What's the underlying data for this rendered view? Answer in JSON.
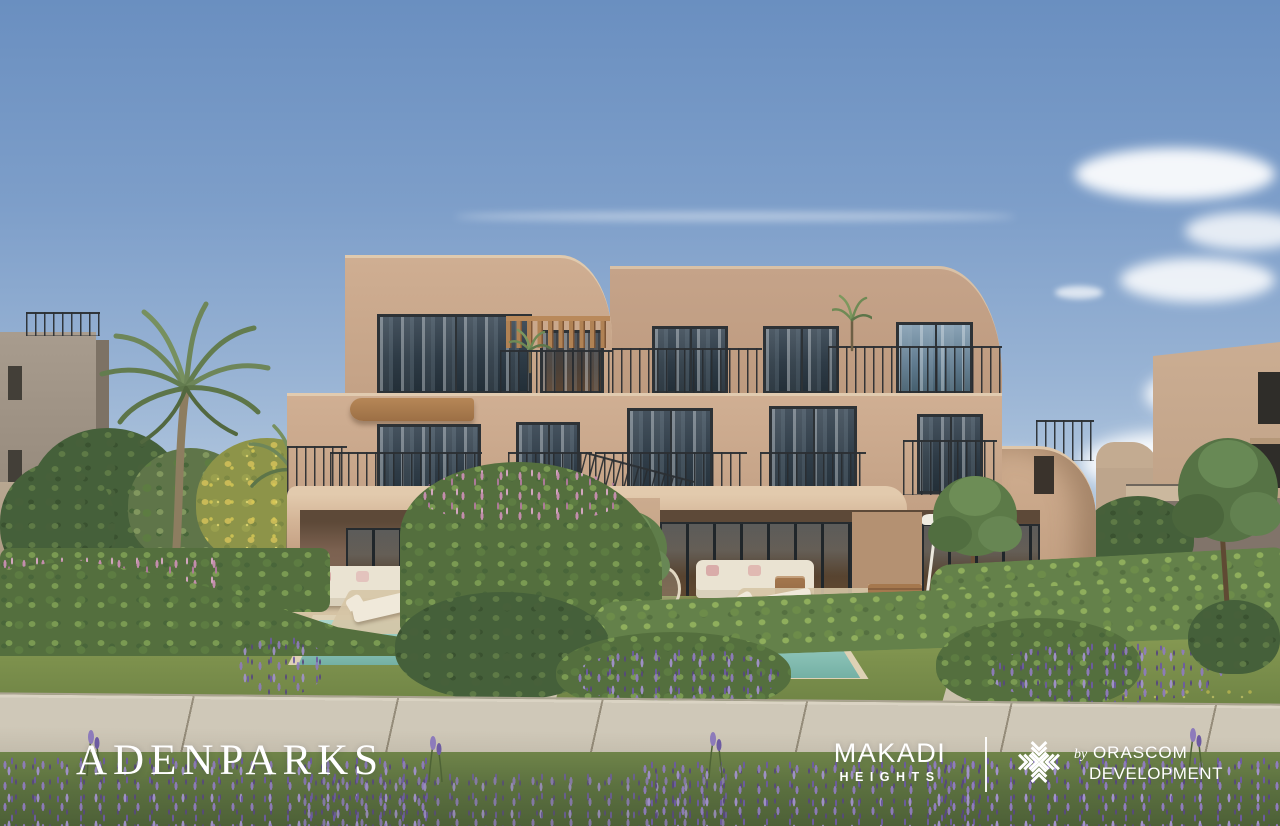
{
  "branding": {
    "adenparks_wordmark": "ADENPARKS",
    "makadi": {
      "line1": "MAKADI",
      "line2": "HEIGHTS"
    },
    "orascom": {
      "by": "by",
      "line1": "ORASCOM",
      "line2": "DEVELOPMENT"
    }
  },
  "colors": {
    "sky_top": "#6a8fc0",
    "sky_horizon": "#d8e1ea",
    "stucco_sunlit": "#cdac90",
    "stucco_shadow": "#a8876e",
    "ground_floor_recess": "#7d6351",
    "window_glass": "#2e3b46",
    "railing": "#2d3236",
    "pergola_wood": "#b08254",
    "pool_water": "#8ec6bd",
    "lawn_green": "#7d914d",
    "hedge_green": "#546f3e",
    "lavender_purple": "#8f7cbd",
    "pink_flowers": "#c98fb2",
    "path_concrete": "#cfc8b8",
    "logo_text": "#ffffff"
  },
  "scene_elements": [
    "sky",
    "clouds",
    "left-neighbor-building",
    "right-neighbor-building",
    "main-villa-facade",
    "balcony-railings",
    "pergola",
    "windows",
    "palm-trees",
    "hedges",
    "flower-beds",
    "private-pools",
    "sun-loungers",
    "outdoor-sofas",
    "garden-lawn",
    "concrete-walkway",
    "lavender-meadow"
  ]
}
